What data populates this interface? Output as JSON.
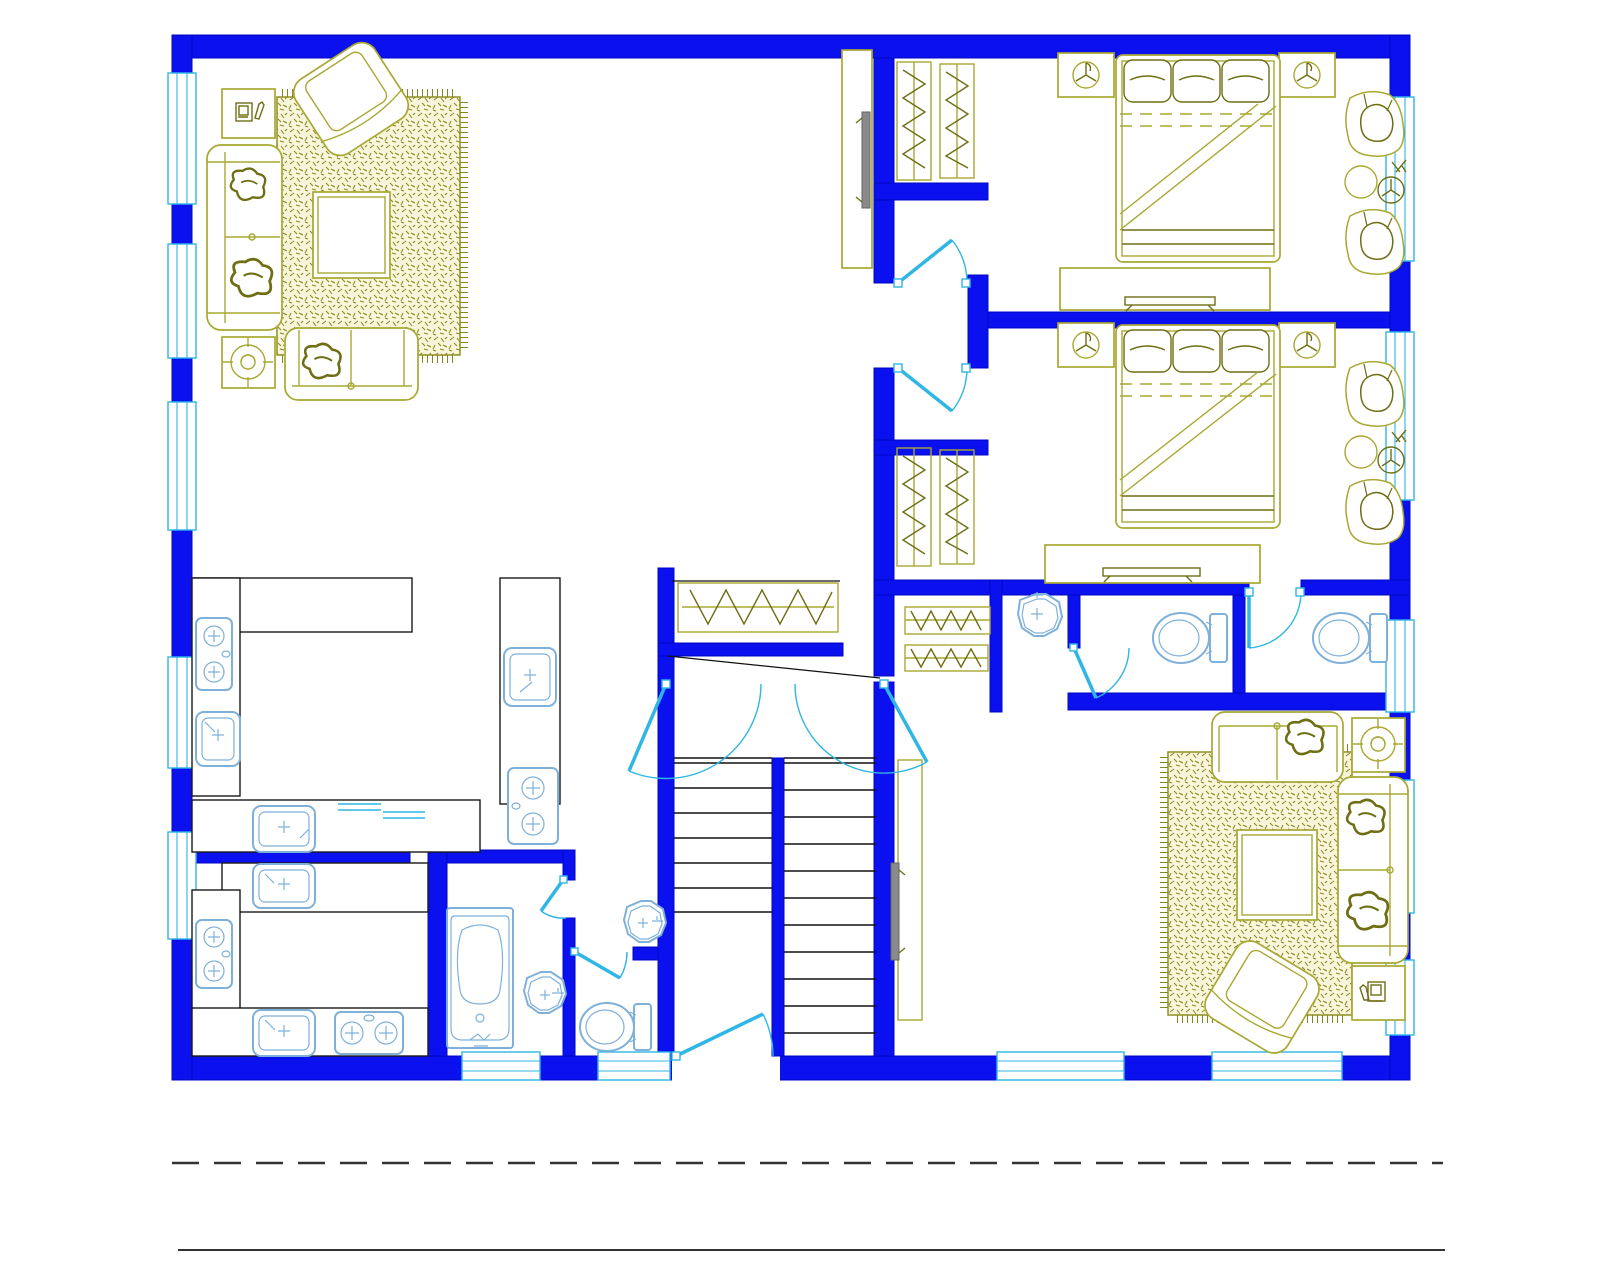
{
  "document": {
    "type": "cad-floor-plan-screenshot",
    "title": "Residential floor plan (no text labels visible)",
    "background": "#ffffff"
  },
  "palette": {
    "wall": "#0b10ee",
    "wall_dark": "#0008c0",
    "opening": "#2fb6e4",
    "fixture": "#7fb0da",
    "furniture": "#a8a832",
    "furniture_dark": "#6e6e14",
    "rug_fill": "#f8f5da",
    "rug_hatch": "#85851e",
    "counter": "#1a1a1a",
    "stair": "#111111",
    "tv": "#8a8a8a",
    "site": "#333333"
  },
  "plan": {
    "wall_color_meaning": "structural walls drawn solid blue",
    "fixtures": [
      {
        "name": "double-bed-with-pillows",
        "count": 2
      },
      {
        "name": "nightstand-with-ceiling-fan-symbol",
        "count": 4
      },
      {
        "name": "dresser-with-tv",
        "count": 2
      },
      {
        "name": "lounge-chair",
        "count": 4
      },
      {
        "name": "round-side-table-with-lamp",
        "count": 2
      },
      {
        "name": "sofa",
        "count": 2
      },
      {
        "name": "loveseat",
        "count": 2
      },
      {
        "name": "rotated-armchair",
        "count": 2
      },
      {
        "name": "area-rug-hatched",
        "count": 2
      },
      {
        "name": "coffee-table",
        "count": 2
      },
      {
        "name": "side-table-with-telephone",
        "count": 2
      },
      {
        "name": "side-table-with-ceiling-fan-symbol",
        "count": 2
      },
      {
        "name": "wall-tv-unit",
        "count": 2
      },
      {
        "name": "closet-hanging-rail-zigzag",
        "count": 7
      },
      {
        "name": "kitchen-sink",
        "count": 5
      },
      {
        "name": "cooktop-two-burner",
        "count": 4
      },
      {
        "name": "wash-basin-octagonal",
        "count": 3
      },
      {
        "name": "toilet",
        "count": 3
      },
      {
        "name": "bathtub",
        "count": 1
      },
      {
        "name": "staircase-double-flight",
        "count": 1
      },
      {
        "name": "swing-door",
        "count": 9
      },
      {
        "name": "window",
        "count": 14
      }
    ],
    "site_lines": {
      "dashed_boundary_line": true,
      "solid_datum_line": true
    }
  }
}
